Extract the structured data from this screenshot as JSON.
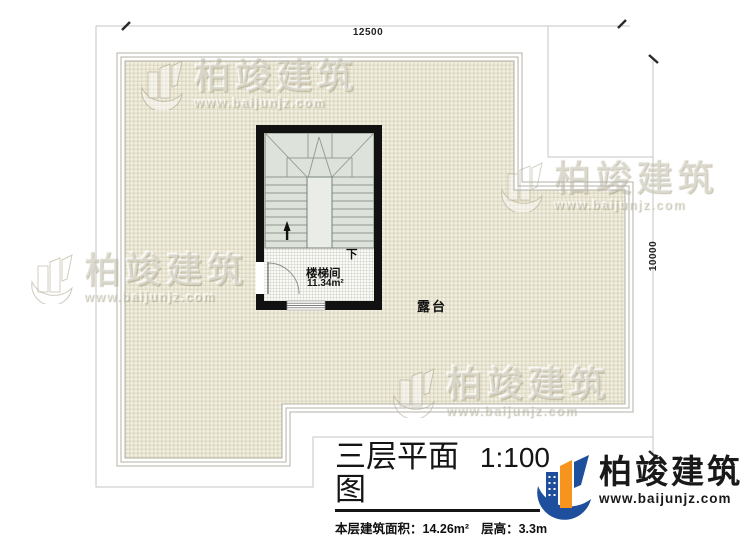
{
  "drawing": {
    "dim_top": "12500",
    "dim_right": "10000",
    "stair_room_label": "楼梯间",
    "stair_room_area": "11.34m²",
    "down_label": "下",
    "terrace_label": "露台"
  },
  "title_block": {
    "title": "三层平面图",
    "scale": "1:100",
    "area_label": "本层建筑面积：",
    "area_value": "14.26m²",
    "height_label": "层高：",
    "height_value": "3.3m"
  },
  "logo": {
    "brand": "柏竣建筑",
    "website": "www.baijunjz.com"
  },
  "watermark": {
    "brand": "柏竣建筑",
    "website": "www.baijunjz.com"
  },
  "colors": {
    "wall": "#111111",
    "terrace_fill": "#f2efe1",
    "stair_fill": "#dde2da",
    "logo_blue": "#1d4f9c",
    "logo_orange": "#f7941d"
  }
}
